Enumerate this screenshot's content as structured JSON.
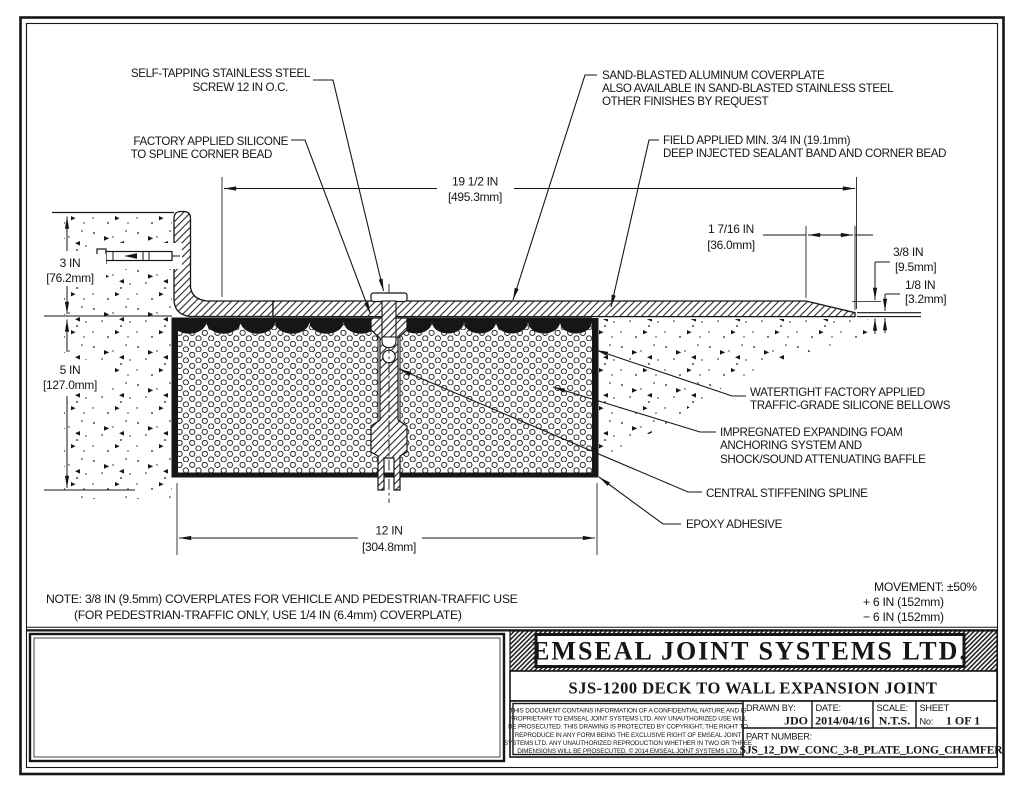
{
  "colors": {
    "ink": "#161616",
    "paper": "#ffffff"
  },
  "callouts": {
    "screw": {
      "line1": "SELF-TAPPING STAINLESS STEEL",
      "line2": "SCREW 12 IN O.C."
    },
    "silicone": {
      "line1": "FACTORY APPLIED SILICONE",
      "line2": "TO SPLINE CORNER BEAD"
    },
    "coverplate": {
      "line1": "SAND-BLASTED ALUMINUM COVERPLATE",
      "line2": "ALSO AVAILABLE IN SAND-BLASTED STAINLESS STEEL",
      "line3": "OTHER FINISHES BY REQUEST"
    },
    "sealant": {
      "line1": "FIELD APPLIED MIN. 3/4 IN (19.1mm)",
      "line2": "DEEP INJECTED SEALANT BAND AND CORNER BEAD"
    },
    "bellows": {
      "line1": "WATERTIGHT FACTORY APPLIED",
      "line2": "TRAFFIC-GRADE SILICONE BELLOWS"
    },
    "foam": {
      "line1": "IMPREGNATED EXPANDING FOAM",
      "line2": "ANCHORING SYSTEM AND",
      "line3": "SHOCK/SOUND ATTENUATING BAFFLE"
    },
    "spline": {
      "line1": "CENTRAL STIFFENING SPLINE"
    },
    "epoxy": {
      "line1": "EPOXY ADHESIVE"
    }
  },
  "dimensions": {
    "overall_width": {
      "in": "19 1/2 IN",
      "mm": "[495.3mm]"
    },
    "chamfer_length": {
      "in": "1 7/16 IN",
      "mm": "[36.0mm]"
    },
    "plate_thickness": {
      "in": "3/8 IN",
      "mm": "[9.5mm]"
    },
    "edge_thickness": {
      "in": "1/8 IN",
      "mm": "[3.2mm]"
    },
    "wall_leg_height": {
      "in": "3 IN",
      "mm": "[76.2mm]"
    },
    "joint_depth": {
      "in": "5 IN",
      "mm": "[127.0mm]"
    },
    "joint_width": {
      "in": "12 IN",
      "mm": "[304.8mm]"
    }
  },
  "note": {
    "line1": "NOTE: 3/8 IN (9.5mm) COVERPLATES FOR VEHICLE AND PEDESTRIAN-TRAFFIC USE",
    "line2": "(FOR PEDESTRIAN-TRAFFIC ONLY, USE 1/4 IN (6.4mm) COVERPLATE)"
  },
  "movement": {
    "line1": "MOVEMENT: ±50%",
    "line2": "+ 6 IN (152mm)",
    "line3": "− 6 IN (152mm)"
  },
  "title_block": {
    "company": "EMSEAL JOINT SYSTEMS LTD.",
    "drawing_title": "SJS-1200 DECK TO WALL EXPANSION JOINT",
    "legal": {
      "line1": "THIS DOCUMENT CONTAINS INFORMATION OF A CONFIDENTIAL NATURE AND IS",
      "line2": "PROPRIETARY TO EMSEAL JOINT SYSTEMS LTD. ANY UNAUTHORIZED USE WILL",
      "line3": "BE PROSECUTED. THIS DRAWING IS PROTECTED BY COPYRIGHT, THE RIGHT TO",
      "line4": "REPRODUCE IN ANY FORM BEING THE EXCLUSIVE RIGHT OF EMSEAL JOINT",
      "line5": "SYSTEMS LTD. ANY UNAUTHORIZED REPRODUCTION WHETHER IN TWO OR THREE",
      "line6": "DIMENSIONS WILL BE PROSECUTED. © 2014 EMSEAL JOINT SYSTEMS LTD."
    },
    "drawn_by_label": "DRAWN BY:",
    "drawn_by_value": "JDO",
    "date_label": "DATE:",
    "date_value": "2014/04/16",
    "scale_label": "SCALE:",
    "scale_value": "N.T.S.",
    "sheet_label": "SHEET",
    "sheet_no_label": "No:",
    "sheet_value": "1 OF 1",
    "part_number_label": "PART NUMBER:",
    "part_number_value": "SJS_12_DW_CONC_3-8_PLATE_LONG_CHAMFER"
  }
}
